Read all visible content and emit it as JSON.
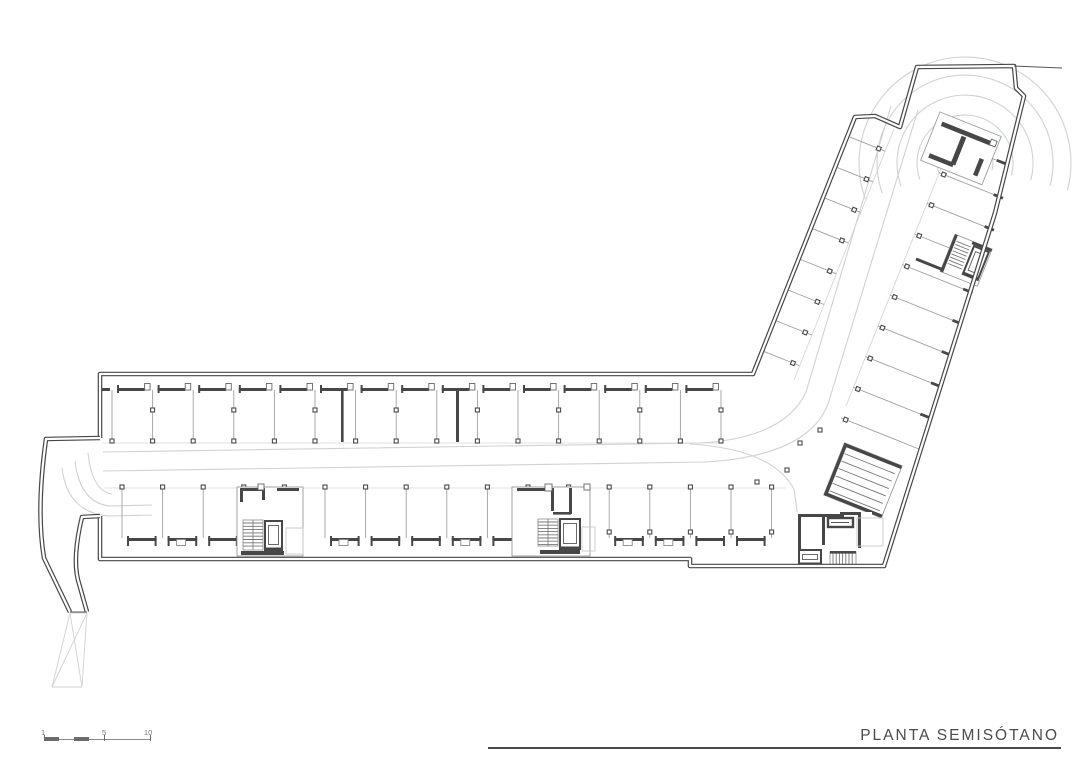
{
  "title_block": {
    "title": "PLANTA SEMISÓTANO"
  },
  "scale_bar": {
    "labels": [
      "1",
      "5",
      "10"
    ]
  },
  "colors": {
    "wall": "#474747",
    "thin": "#9da1a4",
    "faint": "#d4d6d8",
    "guide": "#cfd2d4",
    "paper": "#ffffff"
  },
  "plan": {
    "angle_deg": 21.8,
    "top_bays": {
      "count": 16,
      "start_x": 112,
      "spacing": 40.6,
      "y1": 390,
      "y2": 443
    },
    "bottom_bays": {
      "count": 17,
      "start_x": 122,
      "spacing": 40.6,
      "y1": 489,
      "y2": 538
    },
    "wing_bays": {
      "count_left": 8,
      "count_right": 9,
      "start": -25,
      "spacing": 33
    },
    "entry_arcs": {
      "cx": 965,
      "cy": 163,
      "radii": [
        28,
        48,
        68,
        88,
        106
      ]
    }
  }
}
